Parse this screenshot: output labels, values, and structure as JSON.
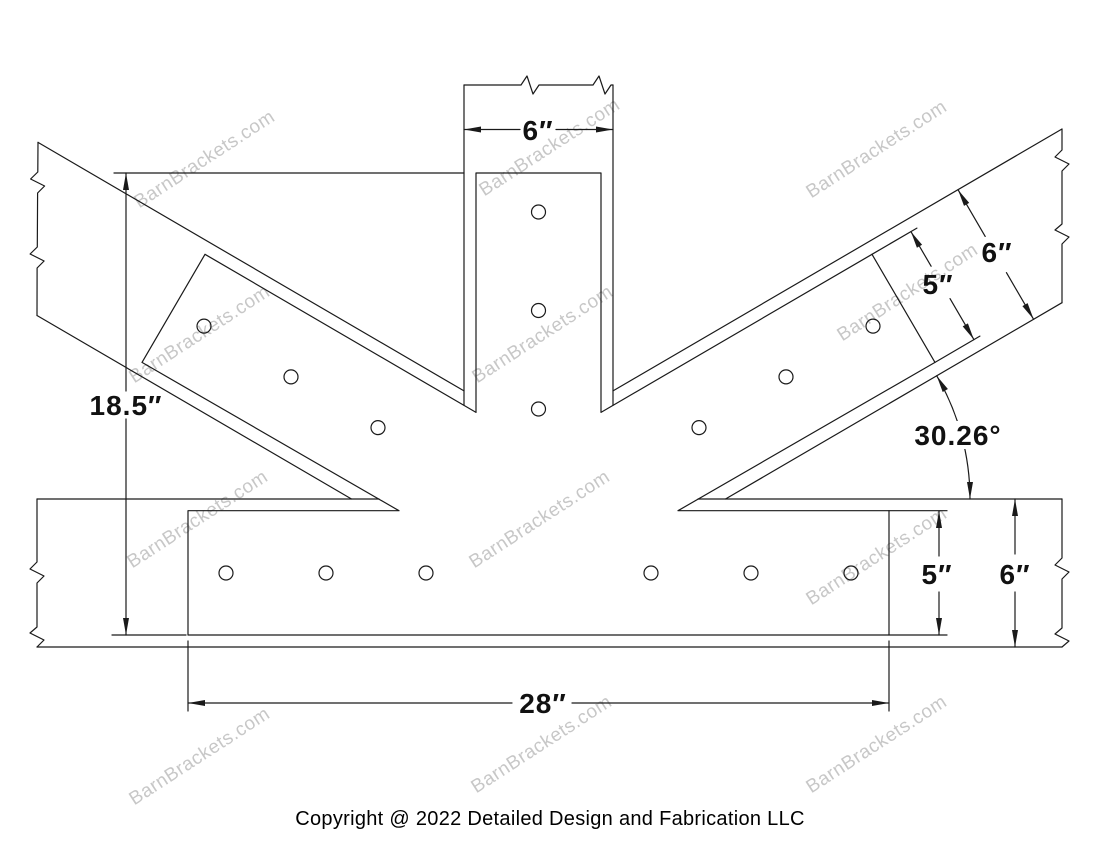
{
  "page": {
    "background_color": "#ffffff",
    "line_color": "#1a1a1a",
    "watermark_color": "#9b9b9b"
  },
  "drawing": {
    "type": "timber fan bracket dimension drawing",
    "dimensions": {
      "top_beam_width": "6″",
      "overall_height": "18.5″",
      "plate_length": "28″",
      "arm_plate_width": "5″",
      "arm_beam_width": "6″",
      "plate_height": "5″",
      "beam_height": "6″",
      "angle": "30.26°"
    },
    "bolt_hole_count": 15
  },
  "watermark": {
    "text": "BarnBrackets.com",
    "positions": [
      [
        205,
        160
      ],
      [
        550,
        148
      ],
      [
        877,
        150
      ],
      [
        200,
        335
      ],
      [
        543,
        335
      ],
      [
        908,
        293
      ],
      [
        198,
        520
      ],
      [
        540,
        520
      ],
      [
        877,
        557
      ],
      [
        200,
        757
      ],
      [
        542,
        745
      ],
      [
        877,
        745
      ]
    ]
  },
  "footer": {
    "copyright": "Copyright @ 2022 Detailed Design and Fabrication LLC"
  }
}
